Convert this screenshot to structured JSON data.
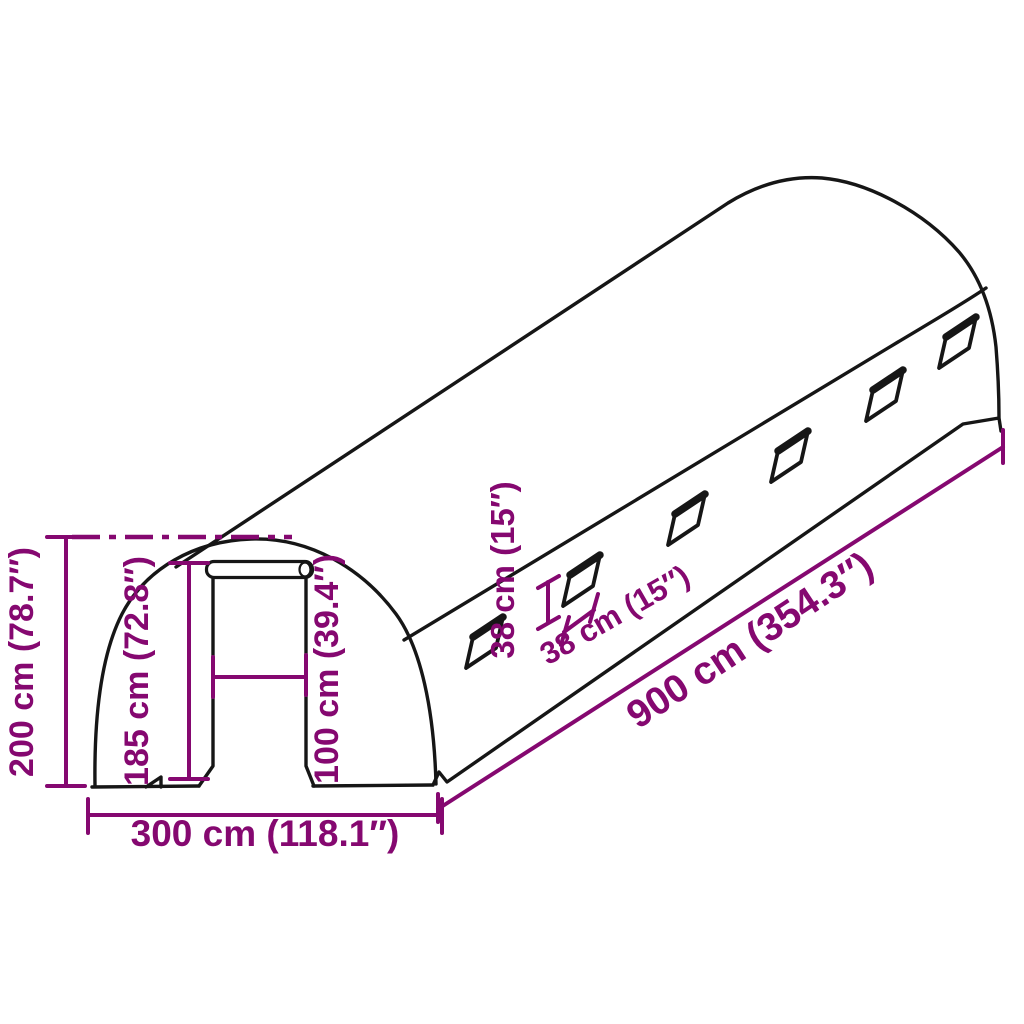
{
  "diagram": {
    "title": "Polytunnel greenhouse dimension drawing",
    "colors": {
      "dimension_accent": "#850870",
      "outline": "#161616",
      "background": "#ffffff"
    },
    "window_count": 6,
    "labels": {
      "height_total": "200 cm (78.7″)",
      "height_door": "185 cm (72.8″)",
      "width_door": "100 cm (39.4″)",
      "width_front": "300 cm (118.1″)",
      "length_side": "900 cm (354.3″)",
      "window_height": "38 cm (15″)",
      "window_width": "38 cm (15″)"
    }
  }
}
